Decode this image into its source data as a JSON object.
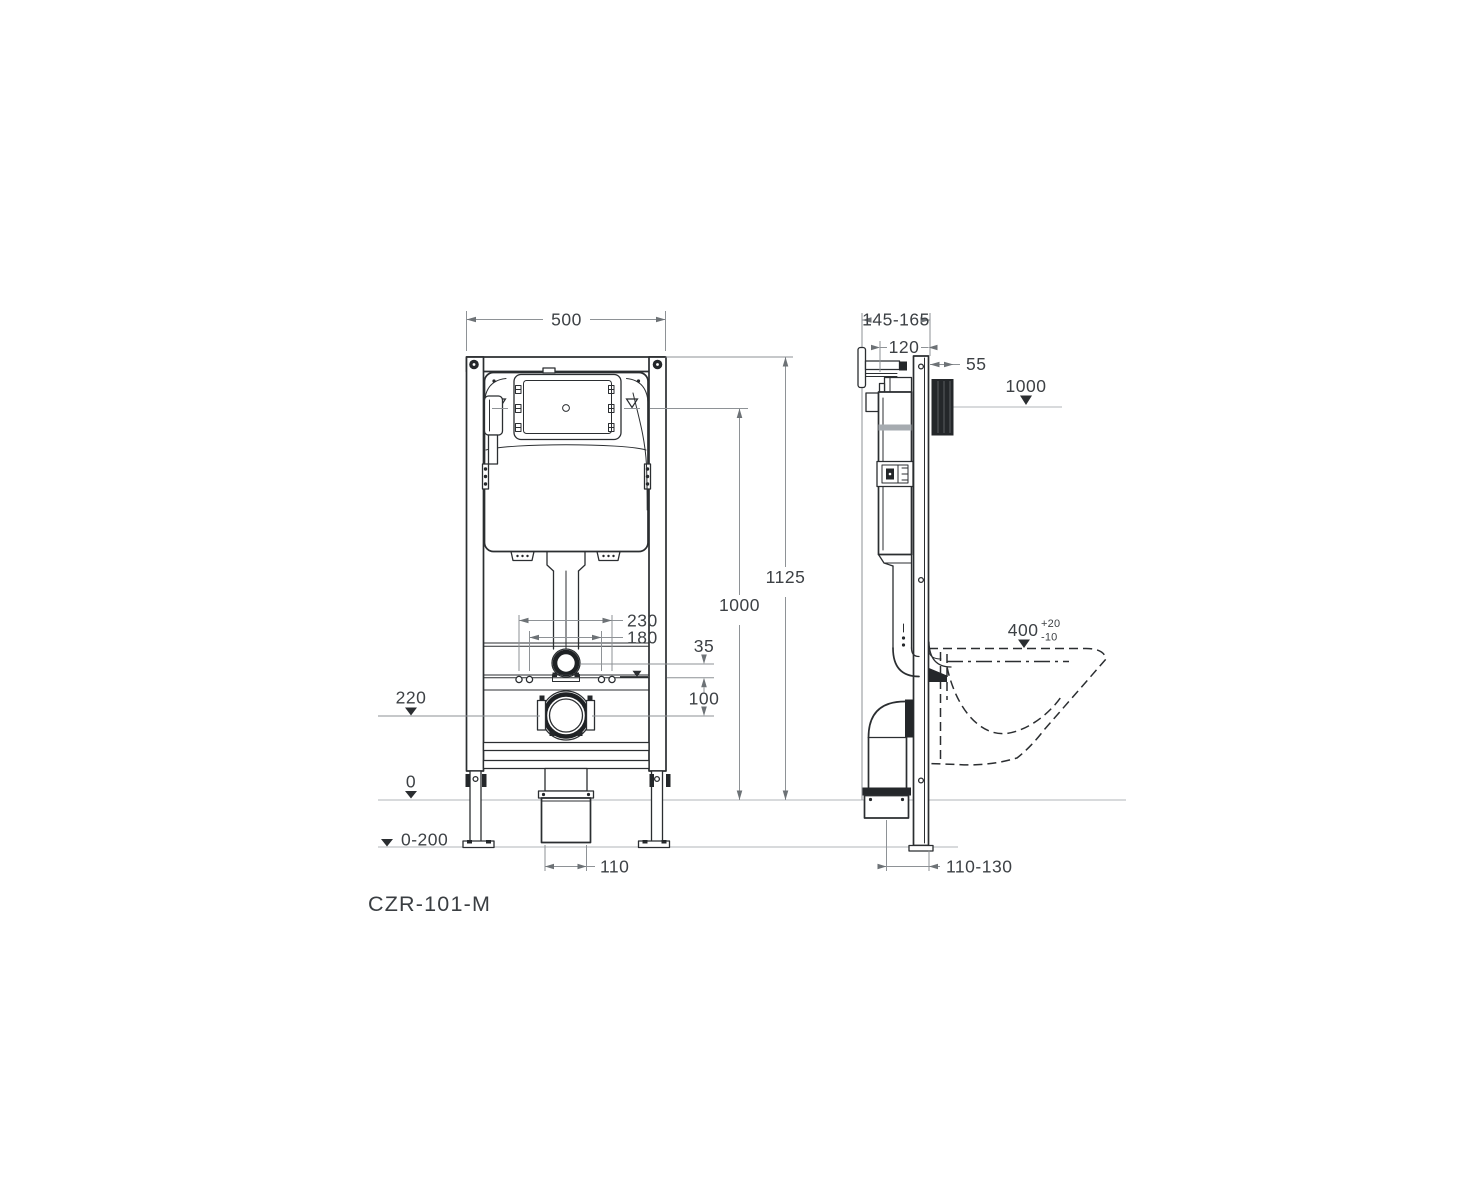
{
  "title": "Concealed WC installation frame technical drawing",
  "model_label": "CZR-101-M",
  "front_view": {
    "frame_width": "500",
    "overall_height": "1125",
    "flush_unit_height": "1000",
    "fixing_spacing_outer": "230",
    "fixing_spacing_inner": "180",
    "flush_pipe_offset": "35",
    "fixing_line_offset": "100",
    "drain_axis_height": "220",
    "floor_level": "0",
    "leg_adjust_range": "0-200",
    "outlet_diameter": "110"
  },
  "side_view": {
    "frame_depth_range": "145-165",
    "cistern_depth": "120",
    "plate_housing_depth": "55",
    "panel_level": "1000",
    "bowl_height": "400",
    "bowl_height_tol_plus": "+20",
    "bowl_height_tol_minus": "-10",
    "outlet_wall_offset": "110-130"
  },
  "colors": {
    "line_ink": "#2b2e31",
    "dimension_gray": "#8e9296",
    "reference_gray": "#b0b4b8",
    "solid_fill": "#24272a",
    "text": "#3d4145"
  }
}
